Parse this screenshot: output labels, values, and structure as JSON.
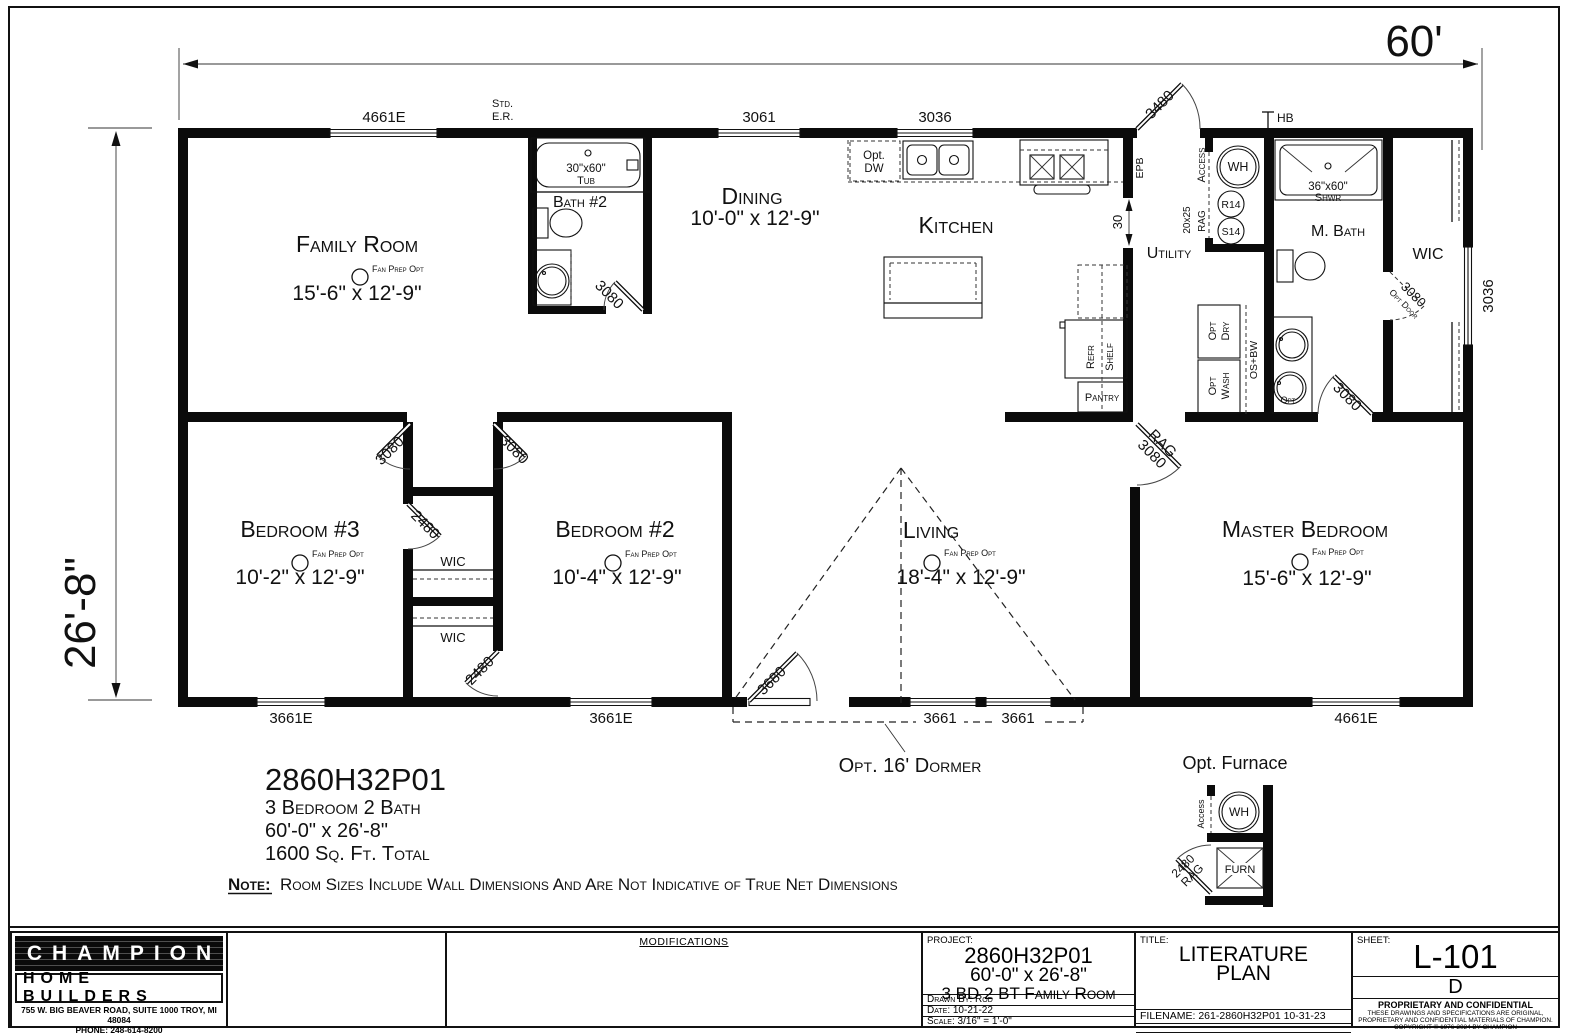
{
  "dims": {
    "overall_width": "60'",
    "overall_depth": "26'-8\"",
    "opening_30": "30"
  },
  "rooms": {
    "family": {
      "name": "Family Room",
      "size": "15'-6\" x 12'-9\""
    },
    "dining": {
      "name": "Dining",
      "size": "10'-0\" x 12'-9\""
    },
    "kitchen": {
      "name": "Kitchen"
    },
    "bath2": {
      "name": "Bath #2"
    },
    "utility": {
      "name": "Utility"
    },
    "mbath": {
      "name": "M. Bath"
    },
    "wic": {
      "name": "WIC"
    },
    "bedroom3": {
      "name": "Bedroom #3",
      "size": "10'-2\" x 12'-9\""
    },
    "bedroom2": {
      "name": "Bedroom #2",
      "size": "10'-4\" x 12'-9\""
    },
    "living": {
      "name": "Living",
      "size": "18'-4\" x 12'-9\""
    },
    "master": {
      "name": "Master Bedroom",
      "size": "15'-6\" x 12'-9\""
    },
    "pantry": {
      "name": "Pantry"
    }
  },
  "windows": {
    "w4661e": "4661E",
    "w3661e": "3661E",
    "w3661": "3661",
    "w3061": "3061",
    "w3036": "3036"
  },
  "doors": {
    "d3080": "3080",
    "d2480": "2480",
    "d3480": "3480",
    "d3680": "3680",
    "opt_door": "Opt Door"
  },
  "fixtures": {
    "tub_size": "30\"x60\"",
    "tub": "Tub",
    "shwr_size": "36\"x60\"",
    "shwr": "Shwr",
    "wh": "WH",
    "r14": "R14",
    "s14": "S14",
    "furn": "FURN",
    "refr": "Refr",
    "shelf": "Shelf",
    "opt": "Opt",
    "dry": "Dry",
    "wash": "Wash",
    "os_bw": "OS+BW",
    "opt_dw_1": "Opt.",
    "opt_dw_2": "DW"
  },
  "annotations": {
    "std_er_1": "Std.",
    "std_er_2": "E.R.",
    "hb": "HB",
    "epb": "EPB",
    "access": "Access",
    "rag": "RAG",
    "grille_20x25": "20x25",
    "fan_prep": "Fan Prep Opt",
    "opt_dormer": "Opt. 16' Dormer",
    "opt_furnace": "Opt. Furnace"
  },
  "summary": {
    "model": "2860H32P01",
    "beds_baths": "3 Bedroom 2 Bath",
    "size": "60'-0\" x 26'-8\"",
    "sqft": "1600 Sq. Ft. Total",
    "note_label": "Note:",
    "note_text": "Room Sizes Include Wall Dimensions And Are Not Indicative of True Net Dimensions"
  },
  "title_block": {
    "company": {
      "name": "CHAMPION",
      "division": "HOME BUILDERS",
      "address": "755 W. BIG BEAVER ROAD, SUITE 1000  TROY, MI  48084",
      "phone": "PHONE: 248-614-8200"
    },
    "modifications_header": "MODIFICATIONS",
    "project": {
      "label": "PROJECT:",
      "model": "2860H32P01",
      "size": "60'-0\" x 26'-8\"",
      "description": "3 BD 2 BT Family Room",
      "drawn_by": "Drawn By: Rod",
      "date": "Date: 10-21-22",
      "scale": "Scale: 3/16\" = 1'-0\""
    },
    "title": {
      "label": "TITLE:",
      "line1": "LITERATURE",
      "line2": "PLAN",
      "filename": "FILENAME: 261-2860H32P01 10-31-23"
    },
    "sheet": {
      "label": "SHEET:",
      "number": "L-101",
      "revision": "D",
      "proprietary": "PROPRIETARY AND CONFIDENTIAL",
      "legal1": "THESE DRAWINGS AND SPECIFICATIONS ARE ORIGINAL,",
      "legal2": "PROPRIETARY AND CONFIDENTIAL MATERIALS OF CHAMPION.",
      "copyright": "COPYRIGHT © 1976-2024 BY CHAMPION"
    }
  }
}
